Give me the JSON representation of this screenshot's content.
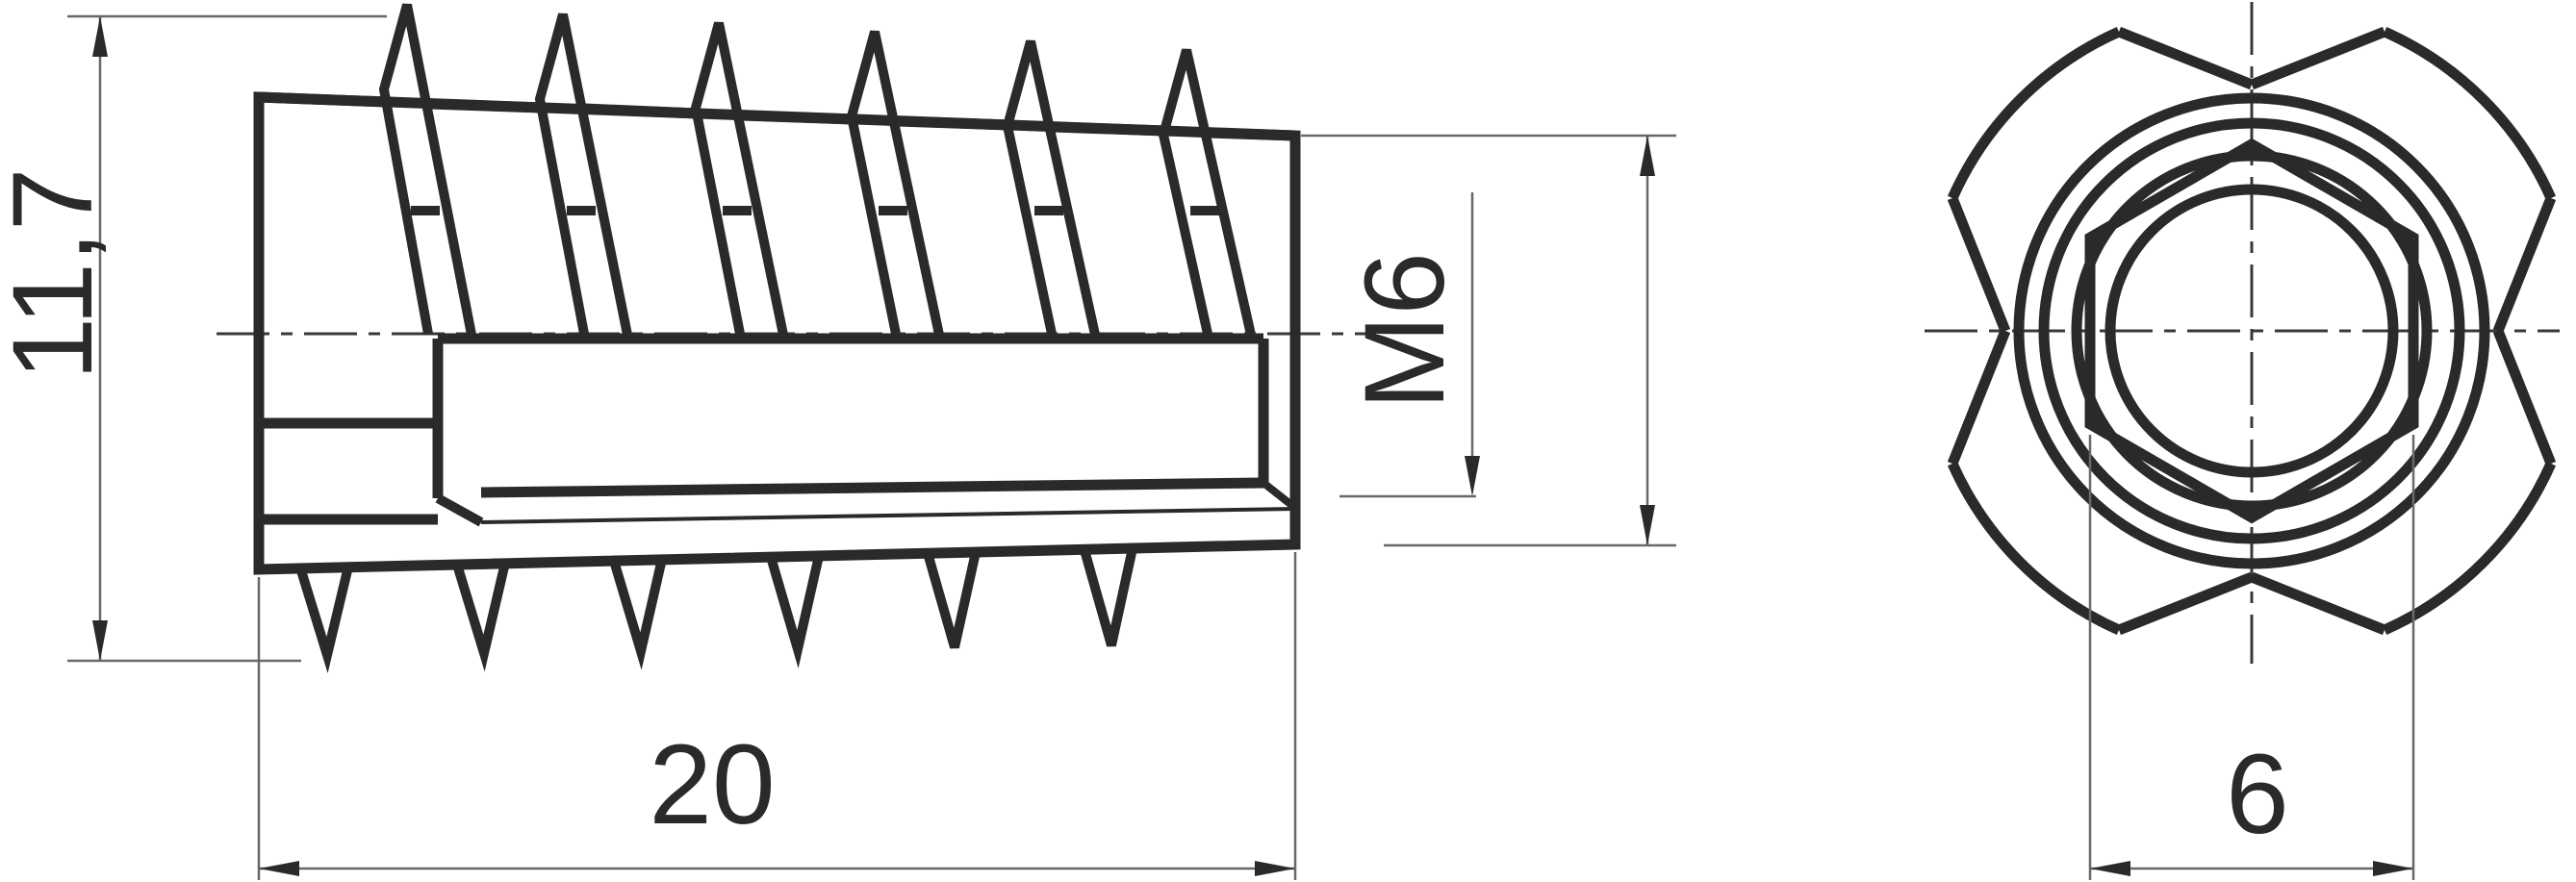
{
  "colors": {
    "ink": "#2b2a29",
    "thin_line": "#6b6965",
    "background": "#ffffff"
  },
  "dimensions": {
    "overall_diameter": "11,7",
    "length": "20",
    "thread": "M6",
    "hex_across_flats": "6"
  }
}
